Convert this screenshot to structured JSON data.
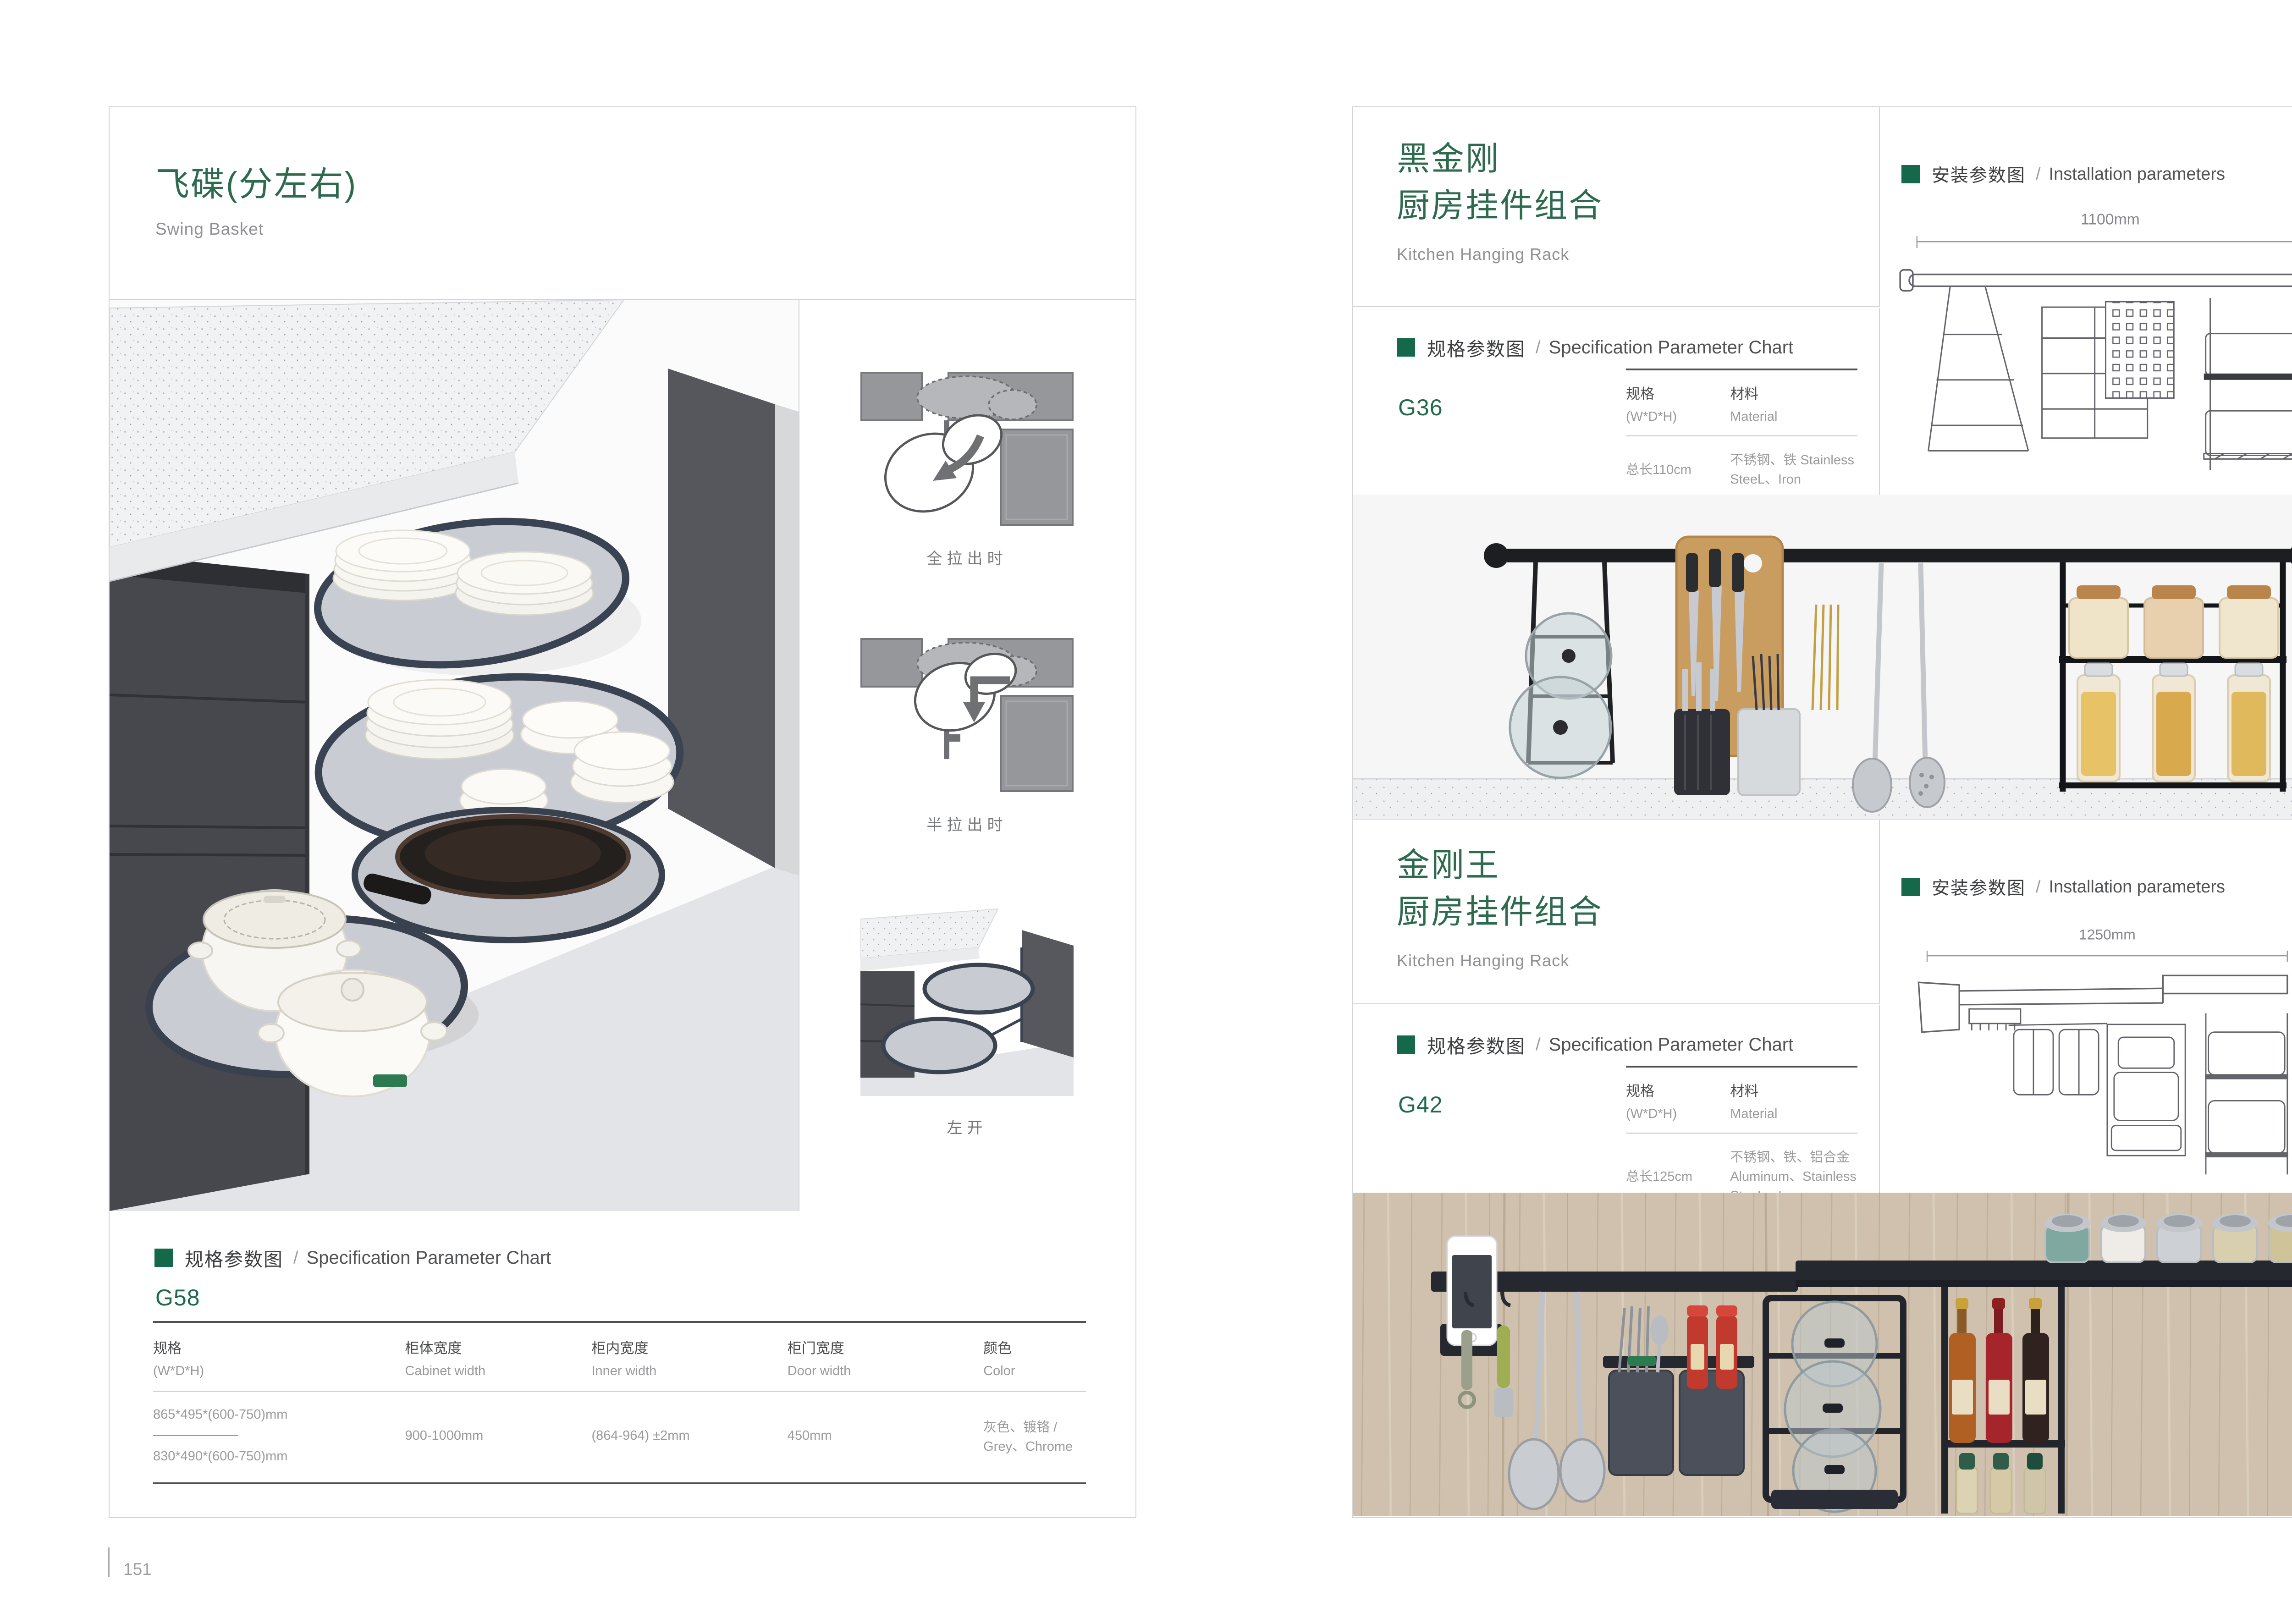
{
  "ui": {
    "slash": "/"
  },
  "colors": {
    "brand_green": "#15694a",
    "title_green": "#2d6a4e",
    "model_green": "#1f6a4b",
    "subtitle_gray": "#8f9093",
    "value_gray": "#9a9b9d"
  },
  "page_left": {
    "page_number": "151",
    "title_cn": "飞碟(分左右)",
    "title_en": "Swing Basket",
    "figures": [
      {
        "caption": "全拉出时"
      },
      {
        "caption": "半拉出时"
      },
      {
        "caption": "左开"
      }
    ],
    "spec": {
      "header_cn": "规格参数图",
      "header_en": "Specification Parameter Chart",
      "model": "G58",
      "columns": [
        {
          "cn": "规格",
          "en": "(W*D*H)"
        },
        {
          "cn": "柜体宽度",
          "en": "Cabinet width"
        },
        {
          "cn": "柜内宽度",
          "en": "Inner width"
        },
        {
          "cn": "柜门宽度",
          "en": "Door width"
        },
        {
          "cn": "颜色",
          "en": "Color"
        }
      ],
      "row": {
        "spec_a": "865*495*(600-750)mm",
        "spec_b": "830*490*(600-750)mm",
        "cabinet_width": "900-1000mm",
        "inner_width": "(864-964) ±2mm",
        "door_width": "450mm",
        "color": "灰色、镀铬 / Grey、Chrome"
      }
    }
  },
  "page_right": {
    "page_number": "152",
    "sections": [
      {
        "title_cn_line1": "黑金刚",
        "title_cn_line2": "厨房挂件组合",
        "title_en": "Kitchen Hanging Rack",
        "spec_header_cn": "规格参数图",
        "spec_header_en": "Specification Parameter Chart",
        "model": "G36",
        "col_spec_cn": "规格",
        "col_spec_en": "(W*D*H)",
        "col_mat_cn": "材料",
        "col_mat_en": "Material",
        "row_spec": "总长110cm",
        "row_material": "不锈钢、铁  Stainless SteeL、Iron",
        "install_cn": "安装参数图",
        "install_en": "Installation parameters",
        "dim_width": "1100mm",
        "dim_height": "420mm"
      },
      {
        "title_cn_line1": "金刚王",
        "title_cn_line2": "厨房挂件组合",
        "title_en": "Kitchen Hanging Rack",
        "spec_header_cn": "规格参数图",
        "spec_header_en": "Specification Parameter Chart",
        "model": "G42",
        "col_spec_cn": "规格",
        "col_spec_en": "(W*D*H)",
        "col_mat_cn": "材料",
        "col_mat_en": "Material",
        "row_spec": "总长125cm",
        "row_material": "不锈钢、铁、铝合金  Aluminum、Stainless SteeL、Iron",
        "install_cn": "安装参数图",
        "install_en": "Installation parameters",
        "dim_width": "1250mm",
        "dim_height": "430mm"
      }
    ]
  }
}
